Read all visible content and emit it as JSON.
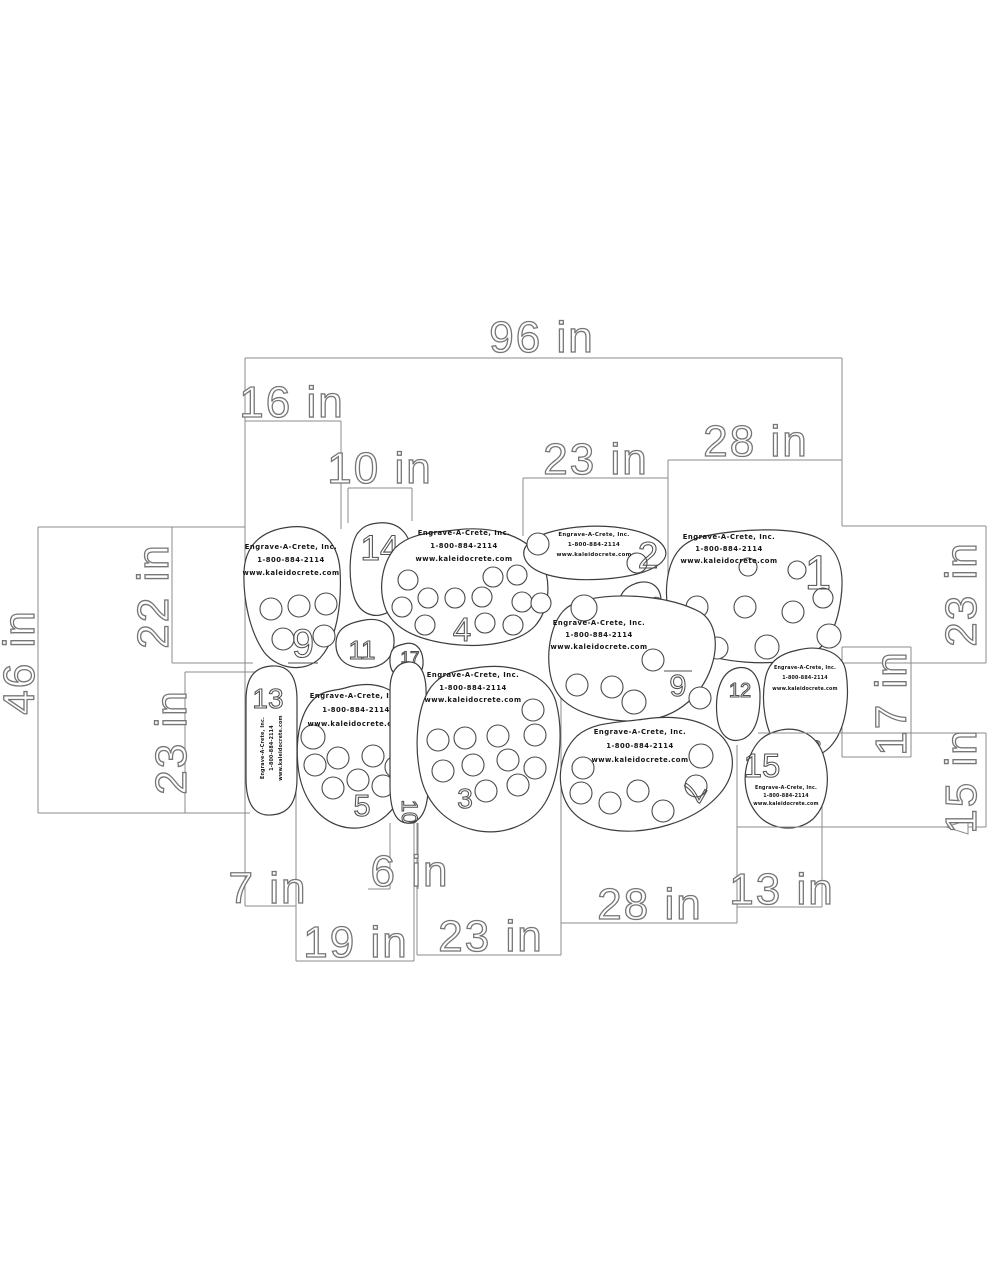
{
  "drawing": {
    "title": "KaleidoCrete stone pattern layout",
    "units": "in"
  },
  "company": {
    "name": "Engrave-A-Crete, Inc.",
    "phone": "1-800-884-2114",
    "website": "www.kaleidocrete.com"
  },
  "dims": {
    "overall_width": "96 in",
    "top_16": "16 in",
    "top_10": "10 in",
    "top_23": "23 in",
    "top_28": "28 in",
    "right_23": "23 in",
    "right_17": "17 in",
    "right_15": "15 in",
    "left_46": "46 in",
    "left_22": "22 in",
    "left_23": "23 in",
    "bottom_7": "7 in",
    "bottom_19": "19 in",
    "bottom_6": "6 in",
    "bottom_23": "23 in",
    "bottom_28": "28 in",
    "bottom_13": "13 in"
  },
  "stones": {
    "n1": "1",
    "n2": "2",
    "n3": "3",
    "n4": "4",
    "n5": "5",
    "n6": "6",
    "n7": "7",
    "n8": "8",
    "n9": "9",
    "n10": "10",
    "n11": "11",
    "n12": "12",
    "n13": "13",
    "n14": "14",
    "n15": "15",
    "n16": "16",
    "n17": "17"
  }
}
